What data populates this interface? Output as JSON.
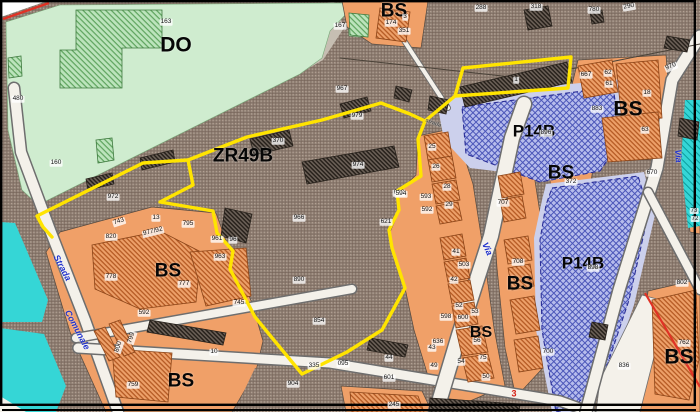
{
  "map": {
    "colors": {
      "boundary_yellow": "#ffe400",
      "water_cyan": "#35d6d6",
      "zone_green": "#cfeccf",
      "zone_brown": "#96867a",
      "zone_orange": "#f0a068",
      "zone_blue": "#b4baea",
      "road": "#f4f1ea",
      "red_accent": "#e03225",
      "road_label_blue": "#2233cc"
    },
    "region_labels": [
      {
        "t": "DO",
        "x": 176,
        "y": 45,
        "s": 21
      },
      {
        "t": "ZR49B",
        "x": 243,
        "y": 156,
        "s": 19
      },
      {
        "t": "BS",
        "x": 394,
        "y": 11,
        "s": 19
      },
      {
        "t": "BS",
        "x": 168,
        "y": 271,
        "s": 19
      },
      {
        "t": "BS",
        "x": 181,
        "y": 381,
        "s": 19
      },
      {
        "t": "BS",
        "x": 520,
        "y": 284,
        "s": 19
      },
      {
        "t": "BS",
        "x": 481,
        "y": 333,
        "s": 16
      },
      {
        "t": "BS",
        "x": 628,
        "y": 109,
        "s": 21
      },
      {
        "t": "BS",
        "x": 561,
        "y": 173,
        "s": 19
      },
      {
        "t": "BS",
        "x": 679,
        "y": 357,
        "s": 21
      },
      {
        "t": "P14B",
        "x": 534,
        "y": 131,
        "s": 17
      },
      {
        "t": "P14B",
        "x": 583,
        "y": 263,
        "s": 17
      }
    ],
    "parcel_numbers": [
      {
        "t": "163",
        "x": 166,
        "y": 22
      },
      {
        "t": "167",
        "x": 340,
        "y": 26
      },
      {
        "t": "174",
        "x": 391,
        "y": 23
      },
      {
        "t": "3",
        "x": 405,
        "y": 17
      },
      {
        "t": "351",
        "x": 404,
        "y": 31
      },
      {
        "t": "288",
        "x": 481,
        "y": 8
      },
      {
        "t": "318",
        "x": 536,
        "y": 7
      },
      {
        "t": "780",
        "x": 594,
        "y": 10
      },
      {
        "t": "290",
        "x": 629,
        "y": 7,
        "rot": -10
      },
      {
        "t": "967",
        "x": 342,
        "y": 89
      },
      {
        "t": "979",
        "x": 357,
        "y": 116
      },
      {
        "t": "370",
        "x": 278,
        "y": 141
      },
      {
        "t": "974",
        "x": 358,
        "y": 165
      },
      {
        "t": "1",
        "x": 516,
        "y": 80
      },
      {
        "t": "480",
        "x": 18,
        "y": 99
      },
      {
        "t": "160",
        "x": 56,
        "y": 163
      },
      {
        "t": "972",
        "x": 113,
        "y": 197
      },
      {
        "t": "743",
        "x": 119,
        "y": 222,
        "rot": -18
      },
      {
        "t": "820",
        "x": 111,
        "y": 237
      },
      {
        "t": "13",
        "x": 156,
        "y": 218
      },
      {
        "t": "977/92",
        "x": 153,
        "y": 232,
        "rot": -14
      },
      {
        "t": "795",
        "x": 188,
        "y": 224
      },
      {
        "t": "961",
        "x": 217,
        "y": 239
      },
      {
        "t": "96",
        "x": 233,
        "y": 240
      },
      {
        "t": "963",
        "x": 220,
        "y": 257
      },
      {
        "t": "966",
        "x": 299,
        "y": 218
      },
      {
        "t": "890",
        "x": 299,
        "y": 280
      },
      {
        "t": "854",
        "x": 319,
        "y": 321
      },
      {
        "t": "778",
        "x": 111,
        "y": 277
      },
      {
        "t": "777",
        "x": 184,
        "y": 284
      },
      {
        "t": "745",
        "x": 239,
        "y": 303
      },
      {
        "t": "592",
        "x": 144,
        "y": 313
      },
      {
        "t": "10",
        "x": 214,
        "y": 352
      },
      {
        "t": "800",
        "x": 119,
        "y": 347,
        "rot": -72
      },
      {
        "t": "799",
        "x": 132,
        "y": 338,
        "rot": -72
      },
      {
        "t": "759",
        "x": 133,
        "y": 385
      },
      {
        "t": "904",
        "x": 293,
        "y": 384
      },
      {
        "t": "335",
        "x": 314,
        "y": 366
      },
      {
        "t": "095",
        "x": 343,
        "y": 364
      },
      {
        "t": "245",
        "x": 394,
        "y": 405
      },
      {
        "t": "44",
        "x": 389,
        "y": 358
      },
      {
        "t": "601",
        "x": 389,
        "y": 378
      },
      {
        "t": "613",
        "x": 399,
        "y": 193
      },
      {
        "t": "621",
        "x": 386,
        "y": 222
      },
      {
        "t": "594",
        "x": 401,
        "y": 194
      },
      {
        "t": "593",
        "x": 426,
        "y": 197
      },
      {
        "t": "592",
        "x": 427,
        "y": 210
      },
      {
        "t": "25",
        "x": 432,
        "y": 147
      },
      {
        "t": "26",
        "x": 436,
        "y": 167
      },
      {
        "t": "28",
        "x": 447,
        "y": 187
      },
      {
        "t": "29",
        "x": 449,
        "y": 205
      },
      {
        "t": "41",
        "x": 456,
        "y": 252
      },
      {
        "t": "503",
        "x": 464,
        "y": 265
      },
      {
        "t": "42",
        "x": 454,
        "y": 280
      },
      {
        "t": "52",
        "x": 459,
        "y": 306
      },
      {
        "t": "598",
        "x": 446,
        "y": 317
      },
      {
        "t": "600",
        "x": 463,
        "y": 318
      },
      {
        "t": "53",
        "x": 475,
        "y": 312
      },
      {
        "t": "56",
        "x": 477,
        "y": 341
      },
      {
        "t": "636",
        "x": 438,
        "y": 342
      },
      {
        "t": "43",
        "x": 432,
        "y": 348
      },
      {
        "t": "49",
        "x": 434,
        "y": 366
      },
      {
        "t": "54",
        "x": 461,
        "y": 362
      },
      {
        "t": "75",
        "x": 483,
        "y": 358
      },
      {
        "t": "50",
        "x": 486,
        "y": 377
      },
      {
        "t": "707",
        "x": 503,
        "y": 203
      },
      {
        "t": "708",
        "x": 518,
        "y": 262
      },
      {
        "t": "700",
        "x": 548,
        "y": 352
      },
      {
        "t": "372",
        "x": 571,
        "y": 182
      },
      {
        "t": "667",
        "x": 586,
        "y": 75
      },
      {
        "t": "62",
        "x": 608,
        "y": 73
      },
      {
        "t": "61",
        "x": 609,
        "y": 84
      },
      {
        "t": "18",
        "x": 647,
        "y": 93
      },
      {
        "t": "883",
        "x": 597,
        "y": 109
      },
      {
        "t": "63",
        "x": 645,
        "y": 130
      },
      {
        "t": "970",
        "x": 671,
        "y": 67,
        "rot": -22
      },
      {
        "t": "670",
        "x": 652,
        "y": 173
      },
      {
        "t": "802",
        "x": 682,
        "y": 283
      },
      {
        "t": "836",
        "x": 624,
        "y": 366
      },
      {
        "t": "762",
        "x": 684,
        "y": 343
      },
      {
        "t": "896",
        "x": 546,
        "y": 133
      },
      {
        "t": "898",
        "x": 593,
        "y": 268
      },
      {
        "t": "73",
        "x": 694,
        "y": 211,
        "s": 6
      },
      {
        "t": "72",
        "x": 695,
        "y": 219,
        "s": 6
      }
    ],
    "road_labels": [
      {
        "t": "Strada",
        "x": 62,
        "y": 268,
        "rot": 62
      },
      {
        "t": "Comunale",
        "x": 77,
        "y": 330,
        "rot": 62
      },
      {
        "t": "Via",
        "x": 487,
        "y": 249,
        "rot": 66
      },
      {
        "t": "Via",
        "x": 678,
        "y": 156,
        "rot": 86
      },
      {
        "t": "strada",
        "x": 433,
        "y": 124,
        "rot": 20,
        "s": 5.5,
        "c": "#555555"
      }
    ],
    "markers": [
      {
        "t": "3",
        "x": 514,
        "y": 394
      }
    ]
  }
}
